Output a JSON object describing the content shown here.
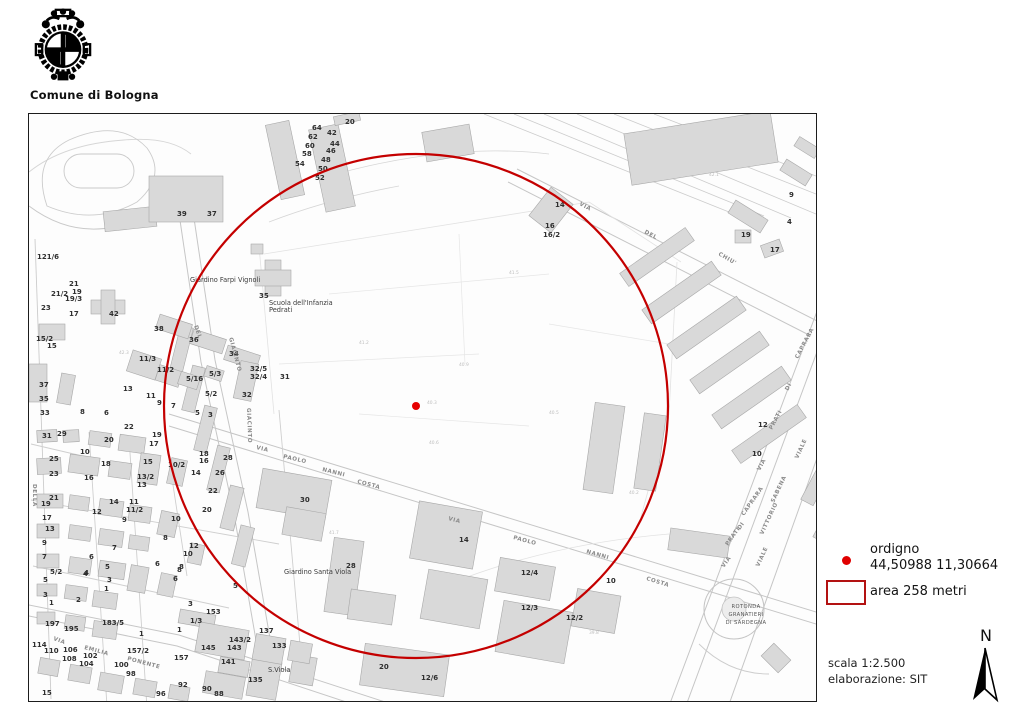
{
  "header": {
    "org": "Comune di Bologna"
  },
  "legend": {
    "point_label": "ordigno",
    "point_coords": "44,50988 11,30664",
    "area_label": "area 258 metri",
    "point_color": "#e00000",
    "area_color": "#b31212"
  },
  "footer": {
    "scale": "scala 1:2.500",
    "elaboration": "elaborazione: SIT",
    "north_letter": "N"
  },
  "map": {
    "overlay": {
      "center_x": 387,
      "center_y": 292,
      "radius_px": 252,
      "circle_color": "#c40000",
      "dot_color": "#e60000"
    },
    "labels": [
      {
        "t": "n",
        "x": 316,
        "y": 10,
        "text": "20"
      },
      {
        "t": "n",
        "x": 283,
        "y": 16,
        "text": "64"
      },
      {
        "t": "n",
        "x": 298,
        "y": 21,
        "text": "42"
      },
      {
        "t": "n",
        "x": 279,
        "y": 25,
        "text": "62"
      },
      {
        "t": "n",
        "x": 301,
        "y": 32,
        "text": "44"
      },
      {
        "t": "n",
        "x": 276,
        "y": 34,
        "text": "60"
      },
      {
        "t": "n",
        "x": 297,
        "y": 39,
        "text": "46"
      },
      {
        "t": "n",
        "x": 273,
        "y": 42,
        "text": "58"
      },
      {
        "t": "n",
        "x": 292,
        "y": 48,
        "text": "48"
      },
      {
        "t": "n",
        "x": 266,
        "y": 52,
        "text": "54"
      },
      {
        "t": "n",
        "x": 289,
        "y": 57,
        "text": "50"
      },
      {
        "t": "n",
        "x": 286,
        "y": 66,
        "text": "52"
      },
      {
        "t": "n",
        "x": 148,
        "y": 102,
        "text": "39"
      },
      {
        "t": "n",
        "x": 178,
        "y": 102,
        "text": "37"
      },
      {
        "t": "n",
        "x": 526,
        "y": 93,
        "text": "14"
      },
      {
        "t": "n",
        "x": 516,
        "y": 114,
        "text": "16"
      },
      {
        "t": "n",
        "x": 514,
        "y": 123,
        "text": "16/2"
      },
      {
        "t": "n",
        "x": 760,
        "y": 83,
        "text": "9"
      },
      {
        "t": "n",
        "x": 758,
        "y": 110,
        "text": "4"
      },
      {
        "t": "n",
        "x": 712,
        "y": 123,
        "text": "19"
      },
      {
        "t": "n",
        "x": 741,
        "y": 138,
        "text": "17"
      },
      {
        "t": "n",
        "x": 8,
        "y": 145,
        "text": "121/6"
      },
      {
        "t": "n",
        "x": 40,
        "y": 172,
        "text": "21"
      },
      {
        "t": "n",
        "x": 22,
        "y": 182,
        "text": "21/2"
      },
      {
        "t": "n",
        "x": 43,
        "y": 180,
        "text": "19"
      },
      {
        "t": "n",
        "x": 36,
        "y": 187,
        "text": "19/3"
      },
      {
        "t": "n",
        "x": 12,
        "y": 196,
        "text": "23"
      },
      {
        "t": "n",
        "x": 40,
        "y": 202,
        "text": "17"
      },
      {
        "t": "n",
        "x": 80,
        "y": 202,
        "text": "42"
      },
      {
        "t": "n",
        "x": 230,
        "y": 184,
        "text": "35"
      },
      {
        "t": "n",
        "x": 7,
        "y": 227,
        "text": "15/2"
      },
      {
        "t": "n",
        "x": 18,
        "y": 234,
        "text": "15"
      },
      {
        "t": "n",
        "x": 125,
        "y": 217,
        "text": "38"
      },
      {
        "t": "n",
        "x": 160,
        "y": 228,
        "text": "36"
      },
      {
        "t": "n",
        "x": 200,
        "y": 242,
        "text": "34"
      },
      {
        "t": "n",
        "x": 110,
        "y": 247,
        "text": "11/3"
      },
      {
        "t": "n",
        "x": 128,
        "y": 258,
        "text": "11/2"
      },
      {
        "t": "n",
        "x": 157,
        "y": 267,
        "text": "5/16"
      },
      {
        "t": "n",
        "x": 180,
        "y": 262,
        "text": "5/3"
      },
      {
        "t": "n",
        "x": 221,
        "y": 257,
        "text": "32/5"
      },
      {
        "t": "n",
        "x": 221,
        "y": 265,
        "text": "32/4"
      },
      {
        "t": "n",
        "x": 213,
        "y": 283,
        "text": "32"
      },
      {
        "t": "n",
        "x": 251,
        "y": 265,
        "text": "31"
      },
      {
        "t": "n",
        "x": 94,
        "y": 277,
        "text": "13"
      },
      {
        "t": "n",
        "x": 117,
        "y": 284,
        "text": "11"
      },
      {
        "t": "n",
        "x": 128,
        "y": 291,
        "text": "9"
      },
      {
        "t": "n",
        "x": 142,
        "y": 294,
        "text": "7"
      },
      {
        "t": "n",
        "x": 176,
        "y": 282,
        "text": "5/2"
      },
      {
        "t": "n",
        "x": 166,
        "y": 301,
        "text": "5"
      },
      {
        "t": "n",
        "x": 179,
        "y": 303,
        "text": "3"
      },
      {
        "t": "n",
        "x": 10,
        "y": 273,
        "text": "37"
      },
      {
        "t": "n",
        "x": 10,
        "y": 287,
        "text": "35"
      },
      {
        "t": "n",
        "x": 11,
        "y": 301,
        "text": "33"
      },
      {
        "t": "n",
        "x": 51,
        "y": 300,
        "text": "8"
      },
      {
        "t": "n",
        "x": 75,
        "y": 301,
        "text": "6"
      },
      {
        "t": "n",
        "x": 13,
        "y": 324,
        "text": "31"
      },
      {
        "t": "n",
        "x": 28,
        "y": 322,
        "text": "29"
      },
      {
        "t": "n",
        "x": 20,
        "y": 347,
        "text": "25"
      },
      {
        "t": "n",
        "x": 20,
        "y": 362,
        "text": "23"
      },
      {
        "t": "n",
        "x": 75,
        "y": 328,
        "text": "20"
      },
      {
        "t": "n",
        "x": 95,
        "y": 315,
        "text": "22"
      },
      {
        "t": "n",
        "x": 51,
        "y": 340,
        "text": "10"
      },
      {
        "t": "n",
        "x": 72,
        "y": 352,
        "text": "18"
      },
      {
        "t": "n",
        "x": 55,
        "y": 366,
        "text": "16"
      },
      {
        "t": "n",
        "x": 123,
        "y": 323,
        "text": "19"
      },
      {
        "t": "n",
        "x": 120,
        "y": 332,
        "text": "17"
      },
      {
        "t": "n",
        "x": 114,
        "y": 350,
        "text": "15"
      },
      {
        "t": "n",
        "x": 108,
        "y": 365,
        "text": "13/2"
      },
      {
        "t": "n",
        "x": 108,
        "y": 373,
        "text": "13"
      },
      {
        "t": "n",
        "x": 80,
        "y": 390,
        "text": "14"
      },
      {
        "t": "n",
        "x": 63,
        "y": 400,
        "text": "12"
      },
      {
        "t": "n",
        "x": 100,
        "y": 390,
        "text": "11"
      },
      {
        "t": "n",
        "x": 97,
        "y": 398,
        "text": "11/2"
      },
      {
        "t": "n",
        "x": 93,
        "y": 408,
        "text": "9"
      },
      {
        "t": "n",
        "x": 20,
        "y": 386,
        "text": "21"
      },
      {
        "t": "n",
        "x": 12,
        "y": 392,
        "text": "19"
      },
      {
        "t": "n",
        "x": 13,
        "y": 406,
        "text": "17"
      },
      {
        "t": "n",
        "x": 16,
        "y": 417,
        "text": "13"
      },
      {
        "t": "n",
        "x": 13,
        "y": 431,
        "text": "9"
      },
      {
        "t": "n",
        "x": 13,
        "y": 445,
        "text": "7"
      },
      {
        "t": "n",
        "x": 21,
        "y": 460,
        "text": "5/2"
      },
      {
        "t": "n",
        "x": 139,
        "y": 353,
        "text": "10/2"
      },
      {
        "t": "n",
        "x": 170,
        "y": 342,
        "text": "18"
      },
      {
        "t": "n",
        "x": 170,
        "y": 349,
        "text": "16"
      },
      {
        "t": "n",
        "x": 162,
        "y": 361,
        "text": "14"
      },
      {
        "t": "n",
        "x": 186,
        "y": 361,
        "text": "26"
      },
      {
        "t": "n",
        "x": 194,
        "y": 346,
        "text": "28"
      },
      {
        "t": "n",
        "x": 179,
        "y": 379,
        "text": "22"
      },
      {
        "t": "n",
        "x": 173,
        "y": 398,
        "text": "20"
      },
      {
        "t": "n",
        "x": 160,
        "y": 434,
        "text": "12"
      },
      {
        "t": "n",
        "x": 154,
        "y": 442,
        "text": "10"
      },
      {
        "t": "n",
        "x": 142,
        "y": 407,
        "text": "10"
      },
      {
        "t": "n",
        "x": 134,
        "y": 426,
        "text": "8"
      },
      {
        "t": "n",
        "x": 150,
        "y": 455,
        "text": "8"
      },
      {
        "t": "n",
        "x": 126,
        "y": 452,
        "text": "6"
      },
      {
        "t": "n",
        "x": 83,
        "y": 436,
        "text": "7"
      },
      {
        "t": "n",
        "x": 60,
        "y": 445,
        "text": "6"
      },
      {
        "t": "n",
        "x": 76,
        "y": 455,
        "text": "5"
      },
      {
        "t": "n",
        "x": 55,
        "y": 461,
        "text": "4"
      },
      {
        "t": "n",
        "x": 271,
        "y": 388,
        "text": "30"
      },
      {
        "t": "n",
        "x": 430,
        "y": 428,
        "text": "14"
      },
      {
        "t": "n",
        "x": 14,
        "y": 468,
        "text": "5"
      },
      {
        "t": "n",
        "x": 14,
        "y": 483,
        "text": "3"
      },
      {
        "t": "n",
        "x": 20,
        "y": 491,
        "text": "1"
      },
      {
        "t": "n",
        "x": 54,
        "y": 462,
        "text": "4"
      },
      {
        "t": "n",
        "x": 47,
        "y": 488,
        "text": "2"
      },
      {
        "t": "n",
        "x": 78,
        "y": 468,
        "text": "3"
      },
      {
        "t": "n",
        "x": 75,
        "y": 477,
        "text": "1"
      },
      {
        "t": "n",
        "x": 16,
        "y": 512,
        "text": "197"
      },
      {
        "t": "n",
        "x": 35,
        "y": 517,
        "text": "195"
      },
      {
        "t": "n",
        "x": 73,
        "y": 511,
        "text": "183/5"
      },
      {
        "t": "n",
        "x": 3,
        "y": 533,
        "text": "114"
      },
      {
        "t": "n",
        "x": 15,
        "y": 539,
        "text": "110"
      },
      {
        "t": "n",
        "x": 34,
        "y": 538,
        "text": "106"
      },
      {
        "t": "n",
        "x": 33,
        "y": 547,
        "text": "108"
      },
      {
        "t": "n",
        "x": 54,
        "y": 544,
        "text": "102"
      },
      {
        "t": "n",
        "x": 50,
        "y": 552,
        "text": "104"
      },
      {
        "t": "n",
        "x": 85,
        "y": 553,
        "text": "100"
      },
      {
        "t": "n",
        "x": 97,
        "y": 562,
        "text": "98"
      },
      {
        "t": "n",
        "x": 98,
        "y": 539,
        "text": "157/2"
      },
      {
        "t": "n",
        "x": 13,
        "y": 581,
        "text": "15"
      },
      {
        "t": "n",
        "x": 148,
        "y": 458,
        "text": "8"
      },
      {
        "t": "n",
        "x": 144,
        "y": 467,
        "text": "6"
      },
      {
        "t": "n",
        "x": 204,
        "y": 474,
        "text": "5"
      },
      {
        "t": "n",
        "x": 159,
        "y": 492,
        "text": "3"
      },
      {
        "t": "n",
        "x": 177,
        "y": 500,
        "text": "153"
      },
      {
        "t": "n",
        "x": 161,
        "y": 509,
        "text": "1/3"
      },
      {
        "t": "n",
        "x": 148,
        "y": 518,
        "text": "1"
      },
      {
        "t": "n",
        "x": 110,
        "y": 522,
        "text": "1"
      },
      {
        "t": "n",
        "x": 230,
        "y": 519,
        "text": "137"
      },
      {
        "t": "n",
        "x": 200,
        "y": 528,
        "text": "143/2"
      },
      {
        "t": "n",
        "x": 198,
        "y": 536,
        "text": "143"
      },
      {
        "t": "n",
        "x": 172,
        "y": 536,
        "text": "145"
      },
      {
        "t": "n",
        "x": 145,
        "y": 546,
        "text": "157"
      },
      {
        "t": "n",
        "x": 243,
        "y": 534,
        "text": "133"
      },
      {
        "t": "n",
        "x": 192,
        "y": 550,
        "text": "141"
      },
      {
        "t": "n",
        "x": 219,
        "y": 568,
        "text": "135"
      },
      {
        "t": "n",
        "x": 149,
        "y": 573,
        "text": "92"
      },
      {
        "t": "n",
        "x": 173,
        "y": 577,
        "text": "90"
      },
      {
        "t": "n",
        "x": 185,
        "y": 582,
        "text": "88"
      },
      {
        "t": "n",
        "x": 127,
        "y": 582,
        "text": "96"
      },
      {
        "t": "n",
        "x": 317,
        "y": 454,
        "text": "28"
      },
      {
        "t": "n",
        "x": 350,
        "y": 555,
        "text": "20"
      },
      {
        "t": "n",
        "x": 392,
        "y": 566,
        "text": "12/6"
      },
      {
        "t": "n",
        "x": 492,
        "y": 461,
        "text": "12/4"
      },
      {
        "t": "n",
        "x": 577,
        "y": 469,
        "text": "10"
      },
      {
        "t": "n",
        "x": 492,
        "y": 496,
        "text": "12/3"
      },
      {
        "t": "n",
        "x": 537,
        "y": 506,
        "text": "12/2"
      },
      {
        "t": "n",
        "x": 729,
        "y": 313,
        "text": "12"
      },
      {
        "t": "n",
        "x": 723,
        "y": 342,
        "text": "10"
      },
      {
        "t": "s",
        "x": 227,
        "y": 335,
        "r": 13,
        "text": "VIA"
      },
      {
        "t": "s",
        "x": 254,
        "y": 344,
        "r": 13,
        "text": "PAOLO"
      },
      {
        "t": "s",
        "x": 293,
        "y": 357,
        "r": 14,
        "text": "NANNI"
      },
      {
        "t": "s",
        "x": 328,
        "y": 369,
        "r": 15,
        "text": "COSTA"
      },
      {
        "t": "s",
        "x": 419,
        "y": 406,
        "r": 15,
        "text": "VIA"
      },
      {
        "t": "s",
        "x": 484,
        "y": 425,
        "r": 15,
        "text": "PAOLO"
      },
      {
        "t": "s",
        "x": 557,
        "y": 439,
        "r": 16,
        "text": "NANNI"
      },
      {
        "t": "s",
        "x": 617,
        "y": 466,
        "r": 17,
        "text": "COSTA"
      },
      {
        "t": "s",
        "x": 550,
        "y": 91,
        "r": 28,
        "text": "VIA"
      },
      {
        "t": "s",
        "x": 615,
        "y": 119,
        "r": 28,
        "text": "DEL"
      },
      {
        "t": "s",
        "x": 689,
        "y": 141,
        "r": 30,
        "text": "CHIU'"
      },
      {
        "t": "s",
        "x": 769,
        "y": 245,
        "r": -62,
        "text": "CAPRARA"
      },
      {
        "t": "s",
        "x": 759,
        "y": 277,
        "r": -62,
        "text": "DI"
      },
      {
        "t": "s",
        "x": 743,
        "y": 316,
        "r": -62,
        "text": "PRATI"
      },
      {
        "t": "s",
        "x": 731,
        "y": 357,
        "r": -62,
        "text": "VIA"
      },
      {
        "t": "s",
        "x": 769,
        "y": 345,
        "r": -65,
        "text": "VIALE"
      },
      {
        "t": "s",
        "x": 745,
        "y": 389,
        "r": -65,
        "text": "SABENA"
      },
      {
        "t": "s",
        "x": 734,
        "y": 421,
        "r": -65,
        "text": "VITTORIO"
      },
      {
        "t": "s",
        "x": 730,
        "y": 453,
        "r": -65,
        "text": "VIALE"
      },
      {
        "t": "s",
        "x": 715,
        "y": 402,
        "r": -55,
        "text": "CAPRARA"
      },
      {
        "t": "s",
        "x": 711,
        "y": 416,
        "r": -55,
        "text": "DI"
      },
      {
        "t": "s",
        "x": 699,
        "y": 432,
        "r": -55,
        "text": "PRATI"
      },
      {
        "t": "s",
        "x": 695,
        "y": 454,
        "r": -55,
        "text": "VIA"
      },
      {
        "t": "s",
        "x": 165,
        "y": 212,
        "r": 70,
        "text": "DEL"
      },
      {
        "t": "s",
        "x": 200,
        "y": 224,
        "r": 75,
        "text": "GIACINTO"
      },
      {
        "t": "s",
        "x": 218,
        "y": 294,
        "r": 88,
        "text": "GIACINTO"
      },
      {
        "t": "s",
        "x": 24,
        "y": 526,
        "r": 20,
        "text": "VIA"
      },
      {
        "t": "s",
        "x": 55,
        "y": 535,
        "r": 15,
        "text": "EMILIA"
      },
      {
        "t": "s",
        "x": 98,
        "y": 546,
        "r": 15,
        "text": "PONENTE"
      },
      {
        "t": "s",
        "x": 4,
        "y": 370,
        "r": 90,
        "text": "DELLA"
      },
      {
        "t": "p",
        "x": 161,
        "y": 168,
        "text": "Giardino Farpi Vignoli"
      },
      {
        "t": "p",
        "x": 240,
        "y": 191,
        "text": "Scuola dell'Infanzia"
      },
      {
        "t": "p",
        "x": 240,
        "y": 198,
        "text": "Pedrati"
      },
      {
        "t": "p",
        "x": 255,
        "y": 460,
        "text": "Giardino Santa Viola"
      },
      {
        "t": "p",
        "x": 239,
        "y": 558,
        "text": "S.Viola"
      },
      {
        "t": "r",
        "x": 717,
        "y": 494,
        "text": "ROTONDA"
      },
      {
        "t": "r",
        "x": 717,
        "y": 502,
        "text": "GRANATIERI"
      },
      {
        "t": "r",
        "x": 717,
        "y": 510,
        "text": "DI SARDEGNA"
      },
      {
        "t": "e",
        "x": 330,
        "y": 230,
        "text": "41.2"
      },
      {
        "t": "e",
        "x": 430,
        "y": 252,
        "text": "40.9"
      },
      {
        "t": "e",
        "x": 520,
        "y": 300,
        "text": "40.5"
      },
      {
        "t": "e",
        "x": 300,
        "y": 420,
        "text": "41.7"
      },
      {
        "t": "e",
        "x": 600,
        "y": 380,
        "text": "40.2"
      },
      {
        "t": "e",
        "x": 480,
        "y": 160,
        "text": "41.5"
      },
      {
        "t": "e",
        "x": 680,
        "y": 62,
        "text": "42.1"
      },
      {
        "t": "e",
        "x": 90,
        "y": 240,
        "text": "42.3"
      },
      {
        "t": "e",
        "x": 400,
        "y": 330,
        "text": "40.6"
      },
      {
        "t": "e",
        "x": 560,
        "y": 520,
        "text": "39.8"
      },
      {
        "t": "e",
        "x": 398,
        "y": 290,
        "text": "40.3"
      }
    ]
  }
}
